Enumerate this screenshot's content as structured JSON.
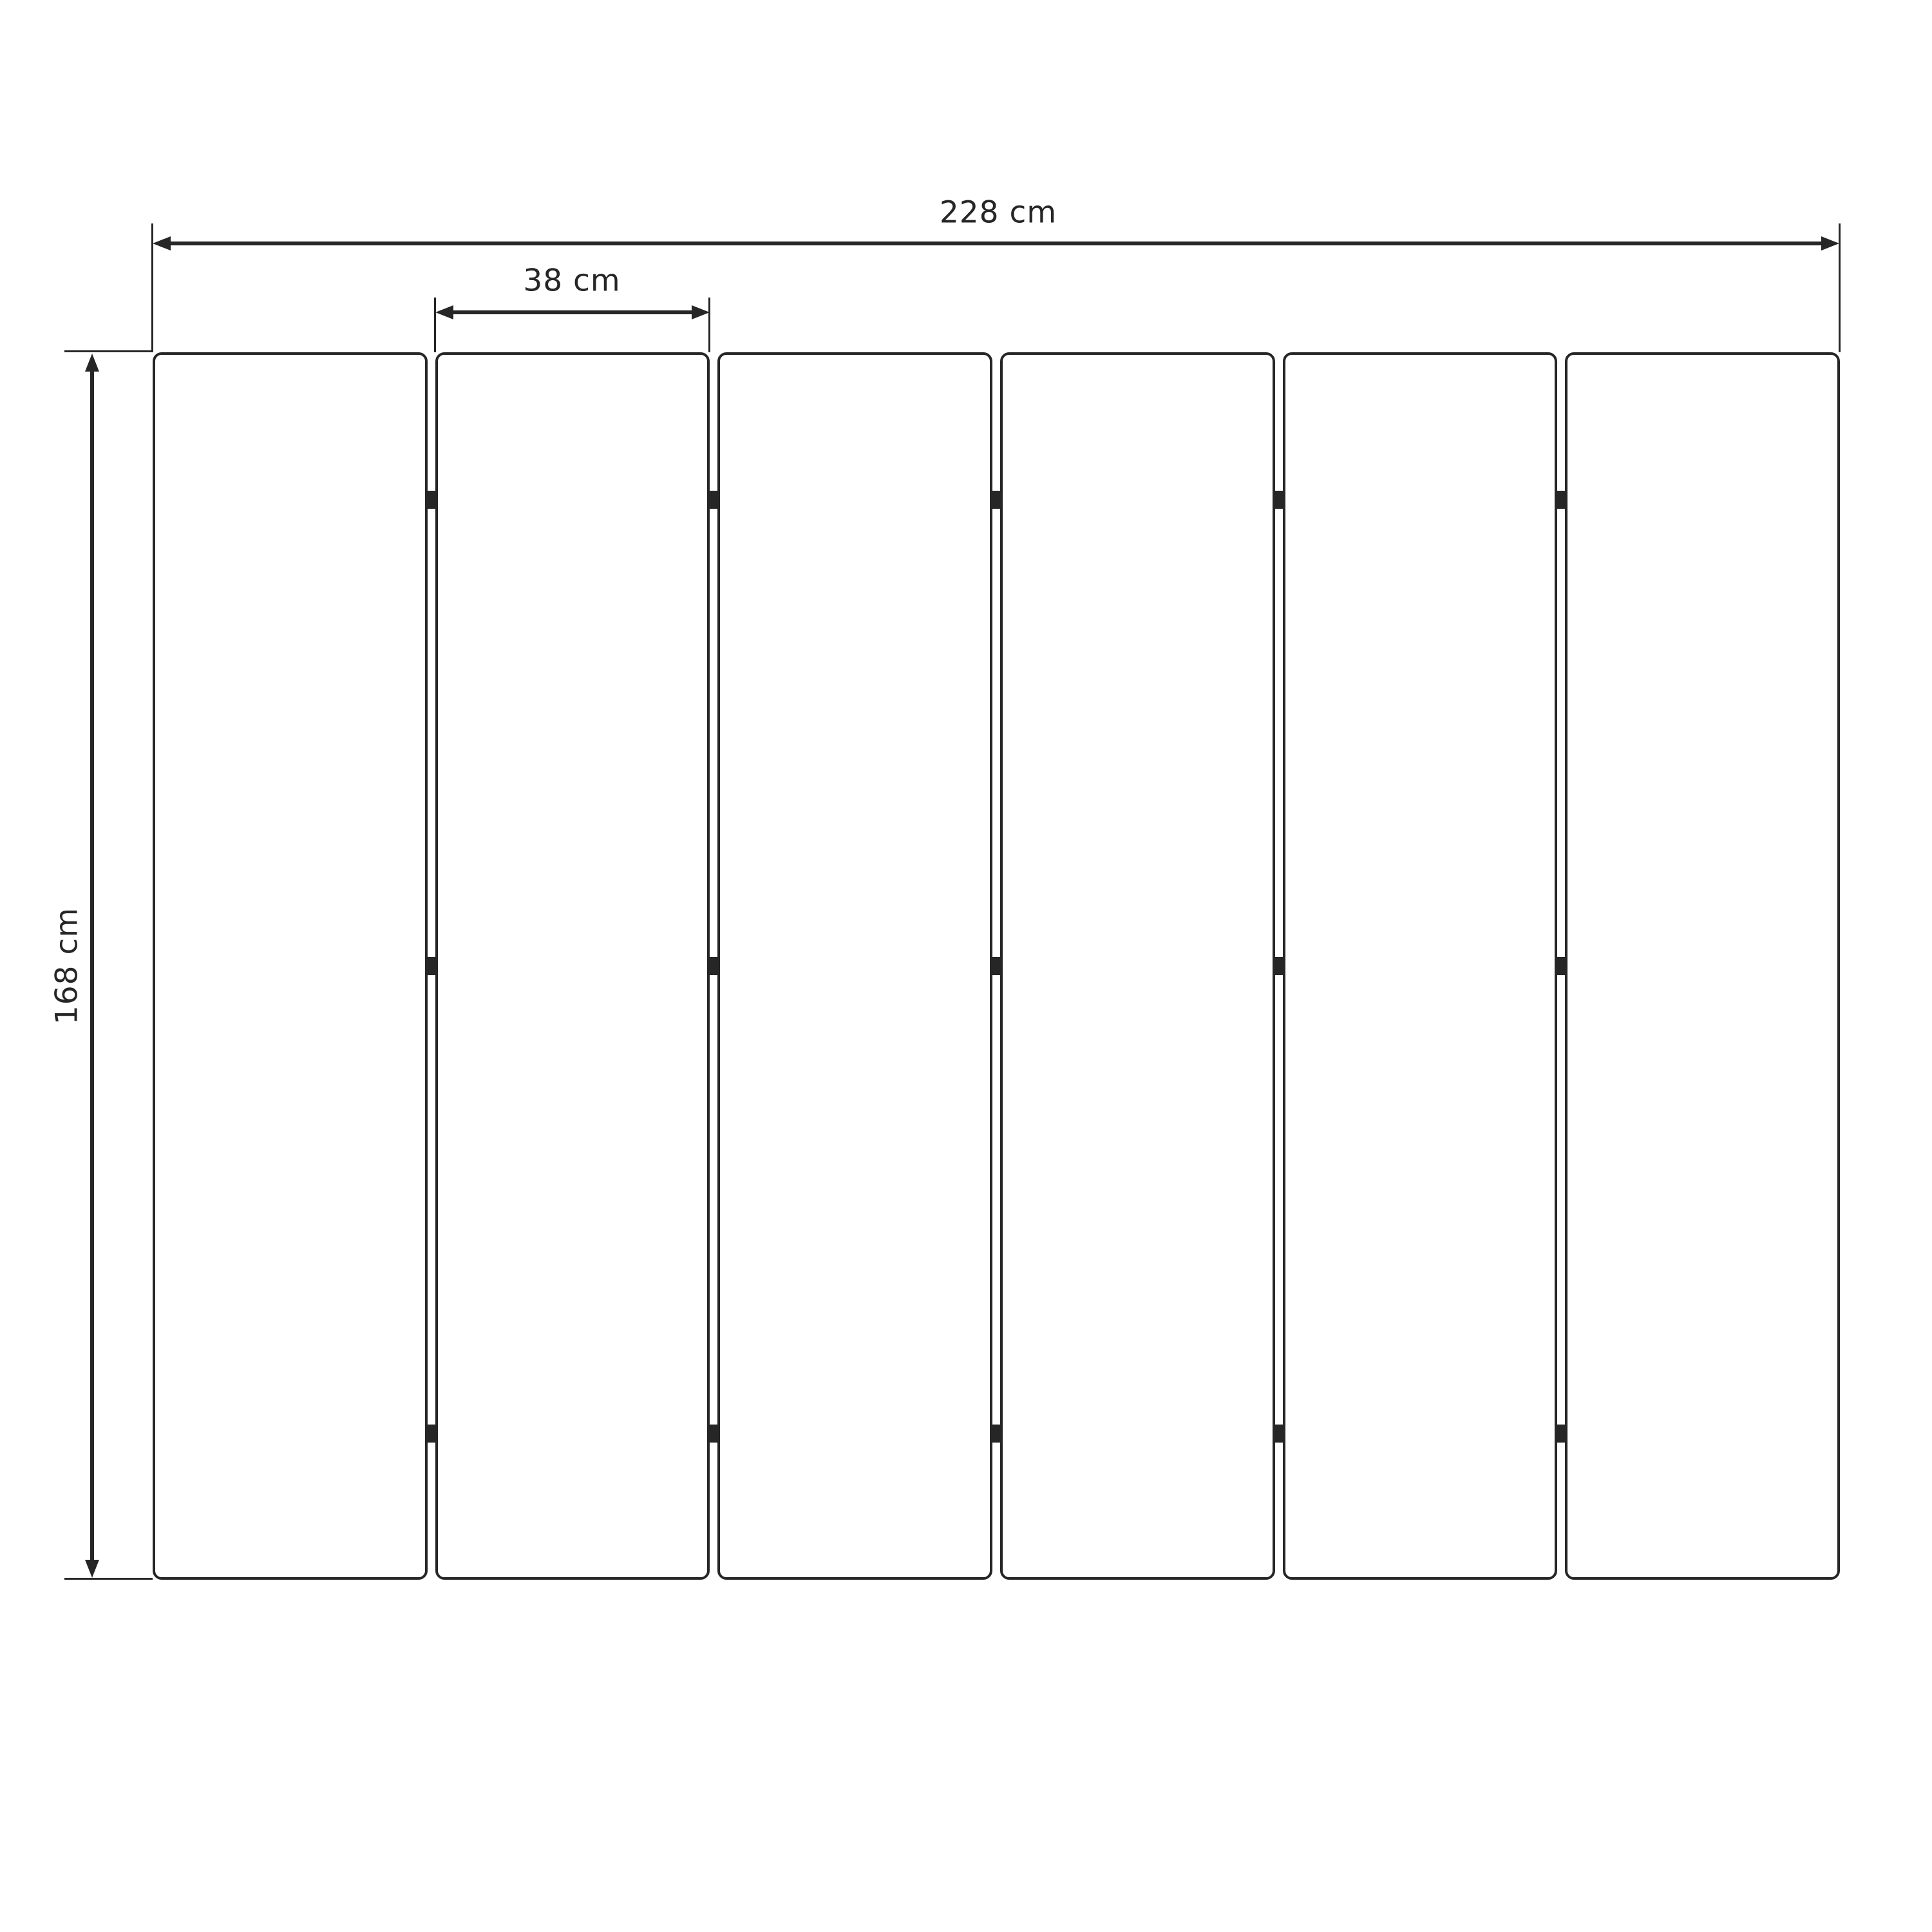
{
  "diagram": {
    "type": "technical-dimension-drawing",
    "panel_count": 6,
    "gap_count": 5,
    "hinges_per_gap": 3,
    "hinge_fractions": [
      0.12,
      0.5,
      0.881
    ],
    "labels": {
      "total_width": "228 cm",
      "panel_width": "38 cm",
      "height": "168 cm"
    },
    "colors": {
      "ink": "#262626",
      "background": "#ffffff",
      "panel_fill": "#ffffff"
    }
  }
}
